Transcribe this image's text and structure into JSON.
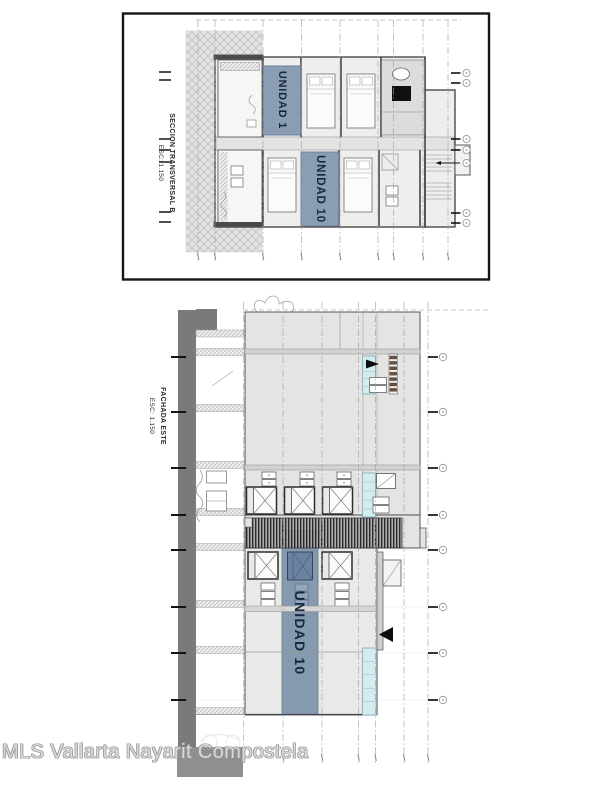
{
  "watermark": {
    "text": "MLS Vallarta Nayarit Compostela"
  },
  "section_drawing": {
    "title": "SECCION TRANSVERSAL B",
    "scale": "ESC: 1.150",
    "units": [
      {
        "label": "UNIDAD 1"
      },
      {
        "label": "UNIDAD 10"
      }
    ]
  },
  "elevation_drawing": {
    "title": "FACHADA ESTE",
    "scale": "ESC: 1.150",
    "units": [
      {
        "label": "UNIDAD 10"
      }
    ]
  },
  "colors": {
    "unit_band": "#8095ac",
    "unit_text": "#182740",
    "glass": "#d3ecef",
    "ground": "#7a7a7a",
    "watermark_fill": "#d8d8d8",
    "watermark_outline": "#979797"
  }
}
